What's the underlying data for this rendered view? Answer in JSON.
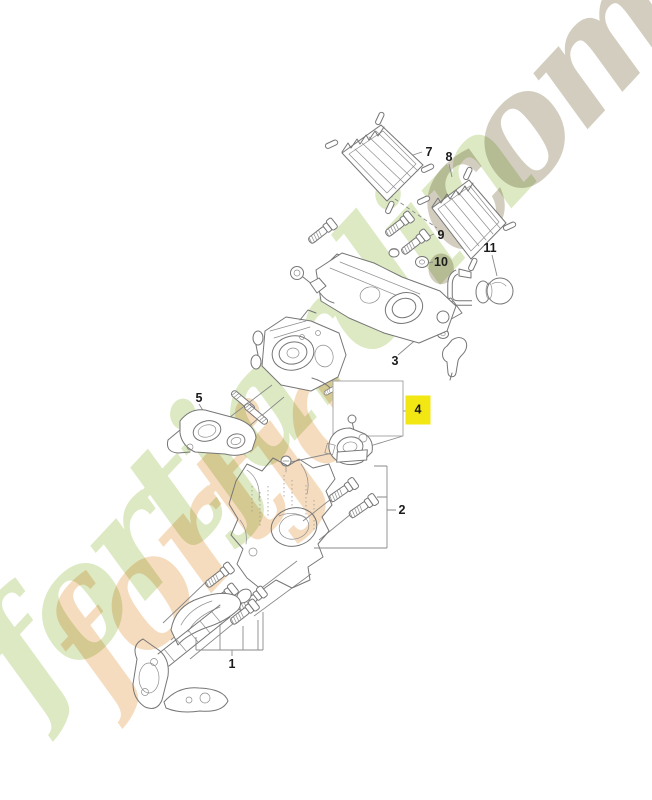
{
  "page": {
    "background": "#ffffff",
    "width": 652,
    "height": 800
  },
  "watermark": {
    "text": "fortjardin.com",
    "main_text": "fortjardin",
    "suffix_text": ".com",
    "echo_text": "fortja",
    "green": "#bcd48c",
    "orange": "#eeb97e",
    "tan": "#b7ae98"
  },
  "diagram": {
    "type": "exploded-parts-diagram",
    "highlight_color": "#f2e713",
    "callouts": [
      {
        "label": "1",
        "x": 232,
        "y": 664,
        "part": "cylinder-muffler-assembly",
        "highlighted": false
      },
      {
        "label": "2",
        "x": 402,
        "y": 510,
        "part": "cylinder-shroud",
        "highlighted": false
      },
      {
        "label": "3",
        "x": 395,
        "y": 361,
        "part": "carburetor-assembly",
        "highlighted": false
      },
      {
        "label": "4",
        "x": 418,
        "y": 410,
        "part": "selected-part",
        "highlighted": true
      },
      {
        "label": "5",
        "x": 199,
        "y": 398,
        "part": "intake-flange",
        "highlighted": false
      },
      {
        "label": "7",
        "x": 429,
        "y": 152,
        "part": "air-filter-left",
        "highlighted": false
      },
      {
        "label": "8",
        "x": 449,
        "y": 157,
        "part": "air-filter-right",
        "highlighted": false
      },
      {
        "label": "9",
        "x": 441,
        "y": 235,
        "part": "screw-set",
        "highlighted": false
      },
      {
        "label": "10",
        "x": 441,
        "y": 262,
        "part": "grommet",
        "highlighted": false
      },
      {
        "label": "11",
        "x": 490,
        "y": 248,
        "part": "primer-bulb",
        "highlighted": false
      }
    ]
  }
}
